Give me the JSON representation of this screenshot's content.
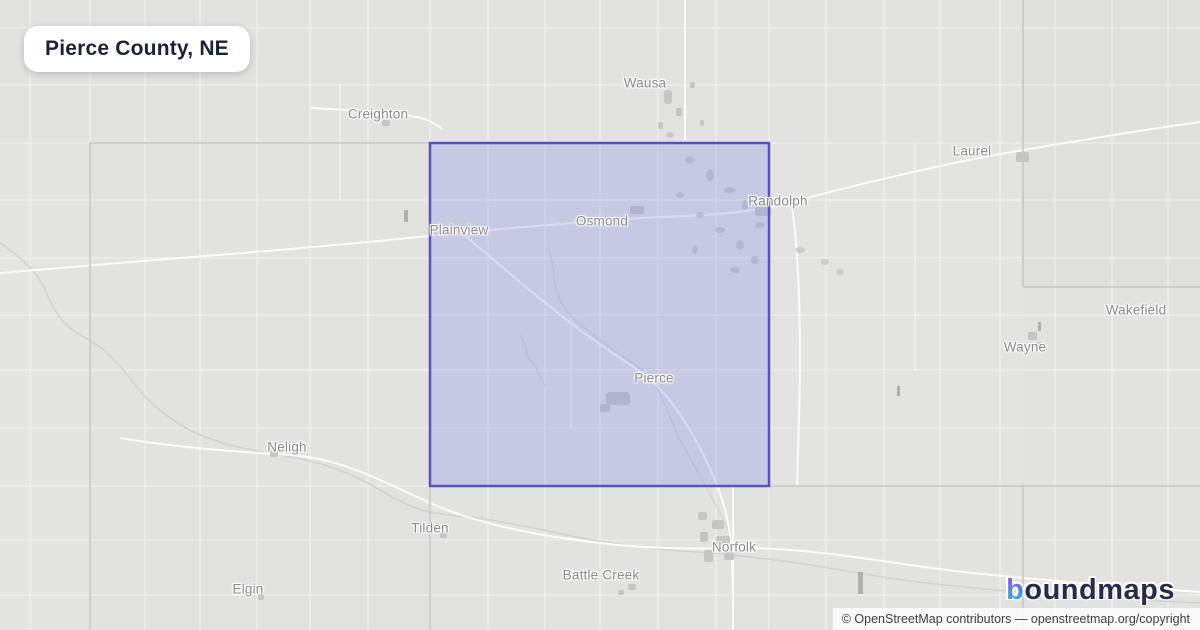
{
  "title_card": {
    "label": "Pierce County, NE"
  },
  "map": {
    "highlighted_county": {
      "name": "Pierce County",
      "fill": "#7b82ea",
      "border": "#5652c6"
    },
    "towns": [
      {
        "name": "Wausa"
      },
      {
        "name": "Creighton"
      },
      {
        "name": "Laurel"
      },
      {
        "name": "Randolph"
      },
      {
        "name": "Plainview"
      },
      {
        "name": "Osmond"
      },
      {
        "name": "Wakefield"
      },
      {
        "name": "Wayne"
      },
      {
        "name": "Pierce"
      },
      {
        "name": "Neligh"
      },
      {
        "name": "Tilden"
      },
      {
        "name": "Norfolk"
      },
      {
        "name": "Battle Creek"
      },
      {
        "name": "Elgin"
      }
    ],
    "colors": {
      "background": "#e2e2e0",
      "road": "#fbfbfa",
      "river": "#d1d1cf",
      "county_line": "#c6c6c4",
      "label_gray": "#8b8b8b"
    }
  },
  "brand": {
    "logo_b": "b",
    "logo_rest": "oundmaps",
    "navy": "#272c4d",
    "gradient_top": "#8a55f0",
    "gradient_bottom": "#2ab5d6"
  },
  "attribution": {
    "text": "© OpenStreetMap contributors — openstreetmap.org/copyright"
  }
}
